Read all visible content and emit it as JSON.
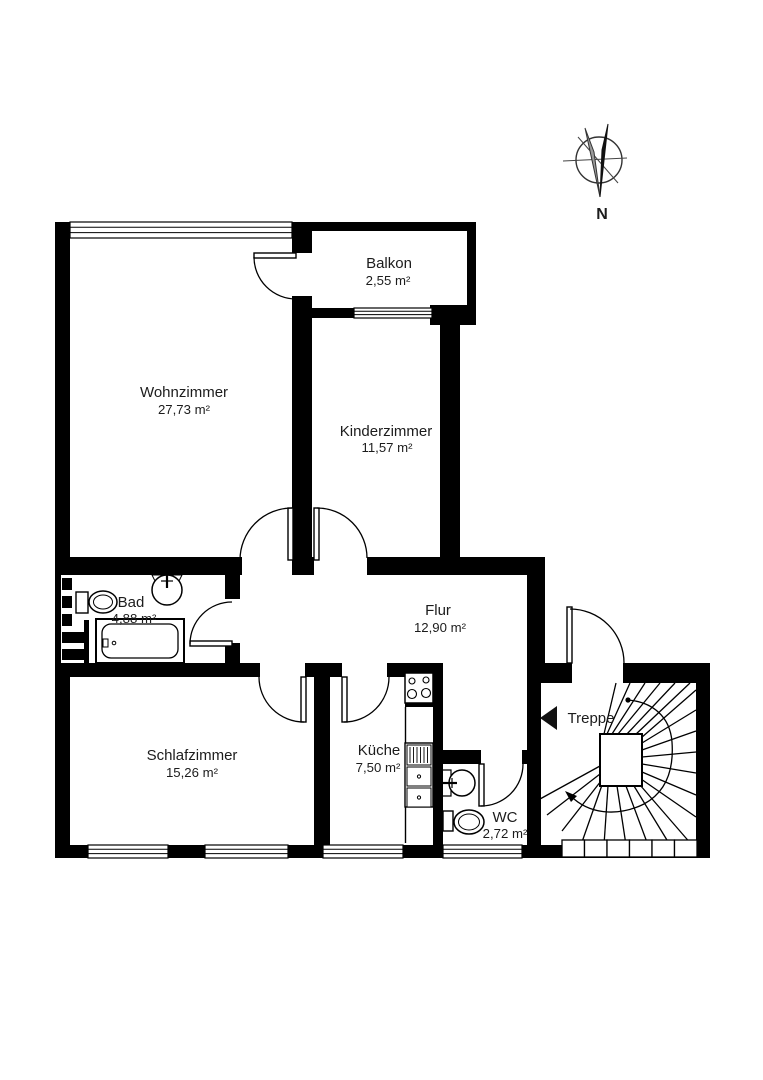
{
  "rooms": {
    "wohnzimmer": {
      "label": "Wohnzimmer",
      "area": "27,73 m²"
    },
    "balkon": {
      "label": "Balkon",
      "area": "2,55 m²"
    },
    "kinderzimmer": {
      "label": "Kinderzimmer",
      "area": "11,57 m²"
    },
    "bad": {
      "label": "Bad",
      "area": "4,88 m²"
    },
    "flur": {
      "label": "Flur",
      "area": "12,90 m²"
    },
    "schlafzimmer": {
      "label": "Schlafzimmer",
      "area": "15,26 m²"
    },
    "kueche": {
      "label": "Küche",
      "area": "7,50 m²"
    },
    "wc": {
      "label": "WC",
      "area": "2,72 m²"
    }
  },
  "stairs": {
    "label": "Treppe"
  },
  "compass": {
    "label": "N"
  },
  "colors": {
    "wall": "#000000",
    "background": "#ffffff",
    "text": "#1c1c1c"
  }
}
